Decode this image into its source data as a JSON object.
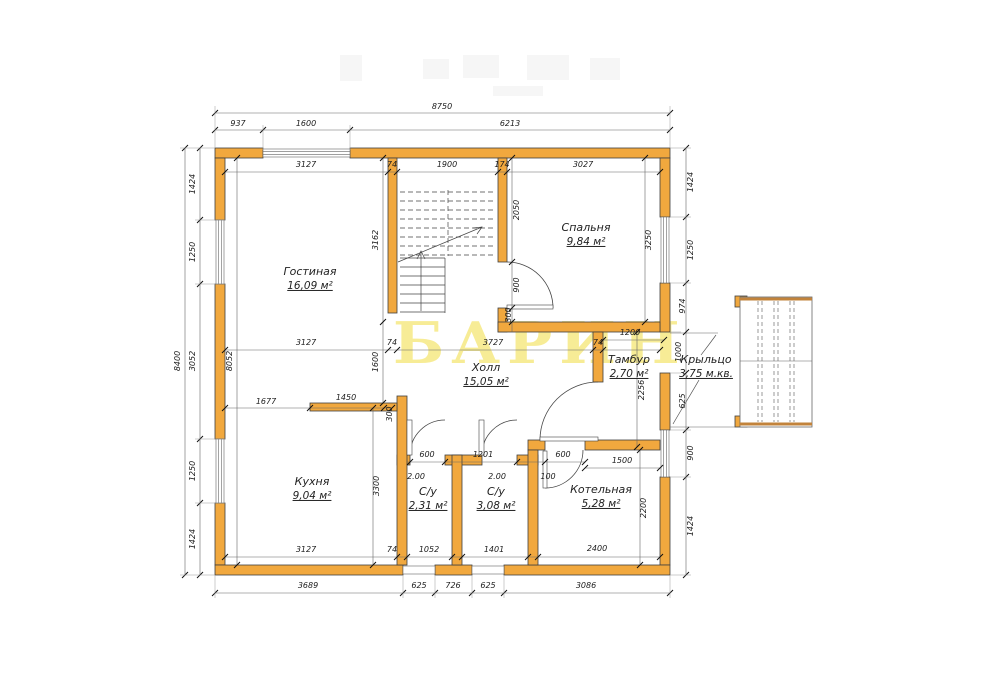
{
  "watermark": {
    "text": "БАРИН",
    "color": "#f6e87c"
  },
  "colors": {
    "wall": "#f1a83e",
    "wall_edge": "#c2833b",
    "line": "#666666"
  },
  "rooms": [
    {
      "name": "Гостиная",
      "area": "16,09 м²",
      "x": 310,
      "y": 272
    },
    {
      "name": "Спальня",
      "area": "9,84 м²",
      "x": 586,
      "y": 228
    },
    {
      "name": "Холл",
      "area": "15,05 м²",
      "x": 486,
      "y": 368
    },
    {
      "name": "Тамбур",
      "area": "2,70 м²",
      "x": 629,
      "y": 360
    },
    {
      "name": "Крыльцо",
      "area": "3,75 м.кв.",
      "x": 706,
      "y": 360
    },
    {
      "name": "Кухня",
      "area": "9,04 м²",
      "x": 312,
      "y": 482
    },
    {
      "name": "С/у",
      "area": "2,31 м²",
      "x": 428,
      "y": 492
    },
    {
      "name": "С/у",
      "area": "3,08 м²",
      "x": 496,
      "y": 492
    },
    {
      "name": "Котельная",
      "area": "5,28 м²",
      "x": 601,
      "y": 490
    }
  ],
  "dim_labels": [
    {
      "t": "8750",
      "x": 442,
      "y": 107,
      "r": 0
    },
    {
      "t": "937",
      "x": 238,
      "y": 124,
      "r": 0
    },
    {
      "t": "1600",
      "x": 306,
      "y": 124,
      "r": 0
    },
    {
      "t": "6213",
      "x": 510,
      "y": 124,
      "r": 0
    },
    {
      "t": "3127",
      "x": 306,
      "y": 165,
      "r": 0
    },
    {
      "t": "74",
      "x": 392,
      "y": 165,
      "r": 0
    },
    {
      "t": "1900",
      "x": 447,
      "y": 165,
      "r": 0
    },
    {
      "t": "174",
      "x": 502,
      "y": 165,
      "r": 0
    },
    {
      "t": "3027",
      "x": 583,
      "y": 165,
      "r": 0
    },
    {
      "t": "8400",
      "x": 178,
      "y": 361,
      "r": 1
    },
    {
      "t": "1424",
      "x": 193,
      "y": 184,
      "r": 1
    },
    {
      "t": "1250",
      "x": 193,
      "y": 252,
      "r": 1
    },
    {
      "t": "3052",
      "x": 193,
      "y": 361,
      "r": 1
    },
    {
      "t": "1250",
      "x": 193,
      "y": 471,
      "r": 1
    },
    {
      "t": "1424",
      "x": 193,
      "y": 539,
      "r": 1
    },
    {
      "t": "8052",
      "x": 230,
      "y": 361,
      "r": 1
    },
    {
      "t": "3162",
      "x": 376,
      "y": 240,
      "r": 1
    },
    {
      "t": "1600",
      "x": 376,
      "y": 362,
      "r": 1
    },
    {
      "t": "2050",
      "x": 517,
      "y": 210,
      "r": 1
    },
    {
      "t": "900",
      "x": 517,
      "y": 285,
      "r": 1
    },
    {
      "t": "300",
      "x": 509,
      "y": 315,
      "r": 1
    },
    {
      "t": "3250",
      "x": 649,
      "y": 240,
      "r": 1
    },
    {
      "t": "1424",
      "x": 691,
      "y": 182,
      "r": 1
    },
    {
      "t": "1250",
      "x": 691,
      "y": 250,
      "r": 1
    },
    {
      "t": "974",
      "x": 683,
      "y": 306,
      "r": 1
    },
    {
      "t": "1000",
      "x": 679,
      "y": 352,
      "r": 1
    },
    {
      "t": "625",
      "x": 683,
      "y": 401,
      "r": 1
    },
    {
      "t": "900",
      "x": 691,
      "y": 453,
      "r": 1
    },
    {
      "t": "1424",
      "x": 691,
      "y": 526,
      "r": 1
    },
    {
      "t": "3127",
      "x": 306,
      "y": 343,
      "r": 0
    },
    {
      "t": "74",
      "x": 392,
      "y": 343,
      "r": 0
    },
    {
      "t": "3727",
      "x": 493,
      "y": 343,
      "r": 0
    },
    {
      "t": "74",
      "x": 598,
      "y": 343,
      "r": 0
    },
    {
      "t": "1200",
      "x": 630,
      "y": 333,
      "r": 0
    },
    {
      "t": "2256",
      "x": 642,
      "y": 390,
      "r": 1
    },
    {
      "t": "1677",
      "x": 266,
      "y": 402,
      "r": 0
    },
    {
      "t": "1450",
      "x": 346,
      "y": 398,
      "r": 0
    },
    {
      "t": "300",
      "x": 390,
      "y": 414,
      "r": 1
    },
    {
      "t": "3300",
      "x": 377,
      "y": 486,
      "r": 1
    },
    {
      "t": "600",
      "x": 427,
      "y": 455,
      "r": 0
    },
    {
      "t": "1201",
      "x": 483,
      "y": 455,
      "r": 0
    },
    {
      "t": "600",
      "x": 563,
      "y": 455,
      "r": 0
    },
    {
      "t": "1500",
      "x": 622,
      "y": 461,
      "r": 0
    },
    {
      "t": "2.00",
      "x": 416,
      "y": 477,
      "r": 0
    },
    {
      "t": "2.00",
      "x": 497,
      "y": 477,
      "r": 0
    },
    {
      "t": "100",
      "x": 548,
      "y": 477,
      "r": 0
    },
    {
      "t": "2200",
      "x": 644,
      "y": 508,
      "r": 1
    },
    {
      "t": "2400",
      "x": 597,
      "y": 549,
      "r": 0
    },
    {
      "t": "3127",
      "x": 306,
      "y": 550,
      "r": 0
    },
    {
      "t": "74",
      "x": 392,
      "y": 550,
      "r": 0
    },
    {
      "t": "1052",
      "x": 429,
      "y": 550,
      "r": 0
    },
    {
      "t": "1401",
      "x": 494,
      "y": 550,
      "r": 0
    },
    {
      "t": "3689",
      "x": 308,
      "y": 586,
      "r": 0
    },
    {
      "t": "625",
      "x": 419,
      "y": 586,
      "r": 0
    },
    {
      "t": "726",
      "x": 453,
      "y": 586,
      "r": 0
    },
    {
      "t": "625",
      "x": 488,
      "y": 586,
      "r": 0
    },
    {
      "t": "3086",
      "x": 586,
      "y": 586,
      "r": 0
    }
  ]
}
